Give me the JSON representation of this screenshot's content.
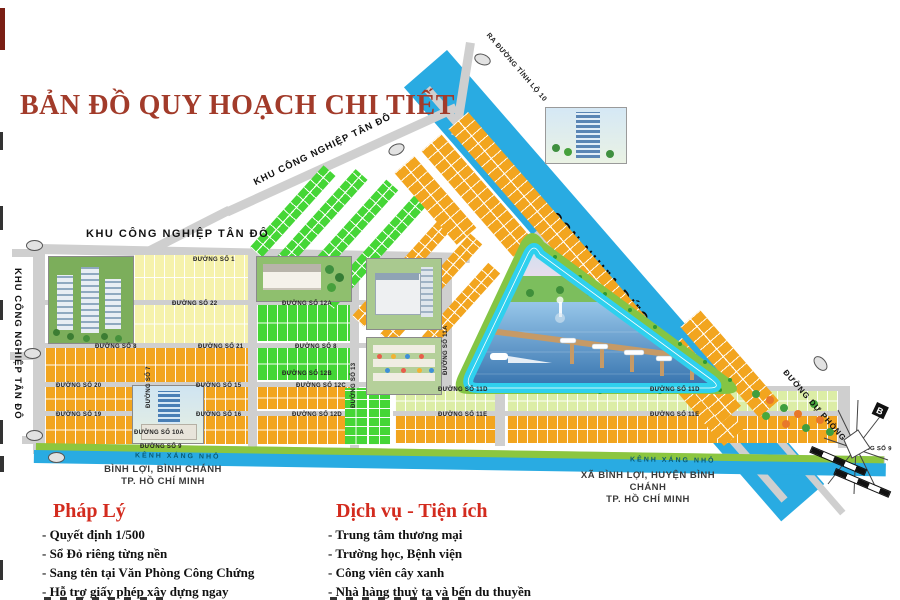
{
  "title": "BẢN ĐỒ QUY HOẠCH CHI TIẾT",
  "map": {
    "industrial_strip": "CCN NHỰA ĐỨC HÒA",
    "exit_road": "RA ĐƯỜNG TỈNH LỘ 10",
    "kcn_top": "KHU CÔNG NGHIỆP TÂN ĐÔ",
    "kcn_left": "KHU CÔNG NGHIỆP TÂN ĐÔ",
    "kcn_diagonal": "KHU CÔNG NGHIỆP TÂN ĐÔ",
    "canal_left": "KÊNH XÁNG NHỎ",
    "canal_right": "KÊNH XÁNG NHỎ",
    "reserve_road": "ĐƯỜNG DỰ PHÒNG",
    "compass_north": "B",
    "locality_left_line1": "BÌNH LỢI, BÌNH CHÁNH",
    "locality_left_line2": "TP. HỒ CHÍ MINH",
    "locality_right_line1": "XÃ BÌNH LỢI, HUYỆN BÌNH CHÁNH",
    "locality_right_line2": "TP. HỒ CHÍ MINH",
    "roads": {
      "no1": "ĐƯỜNG SỐ 1",
      "no7": "ĐƯỜNG SỐ 7",
      "no8": "ĐƯỜNG SỐ 8",
      "no9": "ĐƯỜNG SỐ 9",
      "no10a": "ĐƯỜNG SỐ 10A",
      "no11a": "ĐƯỜNG SỐ 11A",
      "no11d": "ĐƯỜNG SỐ 11D",
      "no11e": "ĐƯỜNG SỐ 11E",
      "no12a": "ĐƯỜNG SỐ 12A",
      "no12b": "ĐƯỜNG SỐ 12B",
      "no12c": "ĐƯỜNG SỐ 12C",
      "no12d": "ĐƯỜNG SỐ 12D",
      "no13": "ĐƯỜNG SỐ 13",
      "no15": "ĐƯỜNG SỐ 15",
      "no16": "ĐƯỜNG SỐ 16",
      "no19": "ĐƯỜNG SỐ 19",
      "no20": "ĐƯỜNG SỐ 20",
      "no21": "ĐƯỜNG SỐ 21",
      "no22": "ĐƯỜNG SỐ 22"
    }
  },
  "legend": {
    "legal": {
      "header": "Pháp Lý",
      "items": [
        "- Quyết định 1/500",
        "- Sổ Đỏ riêng từng nền",
        "- Sang tên tại Văn Phòng Công Chứng",
        "- Hỗ trợ giấy phép xây dựng ngay"
      ]
    },
    "services": {
      "header": "Dịch vụ - Tiện ích",
      "items": [
        "- Trung tâm thương mại",
        "- Trường học, Bệnh viện",
        "- Công viên cây xanh",
        "- Nhà hàng thuỷ tạ và bến du thuyền"
      ]
    }
  },
  "colors": {
    "title_red": "#A23B2A",
    "legend_red": "#D32B1E",
    "strip_blue": "#29ABE2",
    "canal_blue": "#29ABE2",
    "lot_orange": "#F2A51F",
    "lot_pale_yellow": "#F6F2AC",
    "lot_green": "#45D636",
    "lot_pale_green": "#DCEDA6",
    "road_gray": "#CFCFCF",
    "belt_green": "#84C544",
    "track_cyan": "#2FD0EE"
  }
}
